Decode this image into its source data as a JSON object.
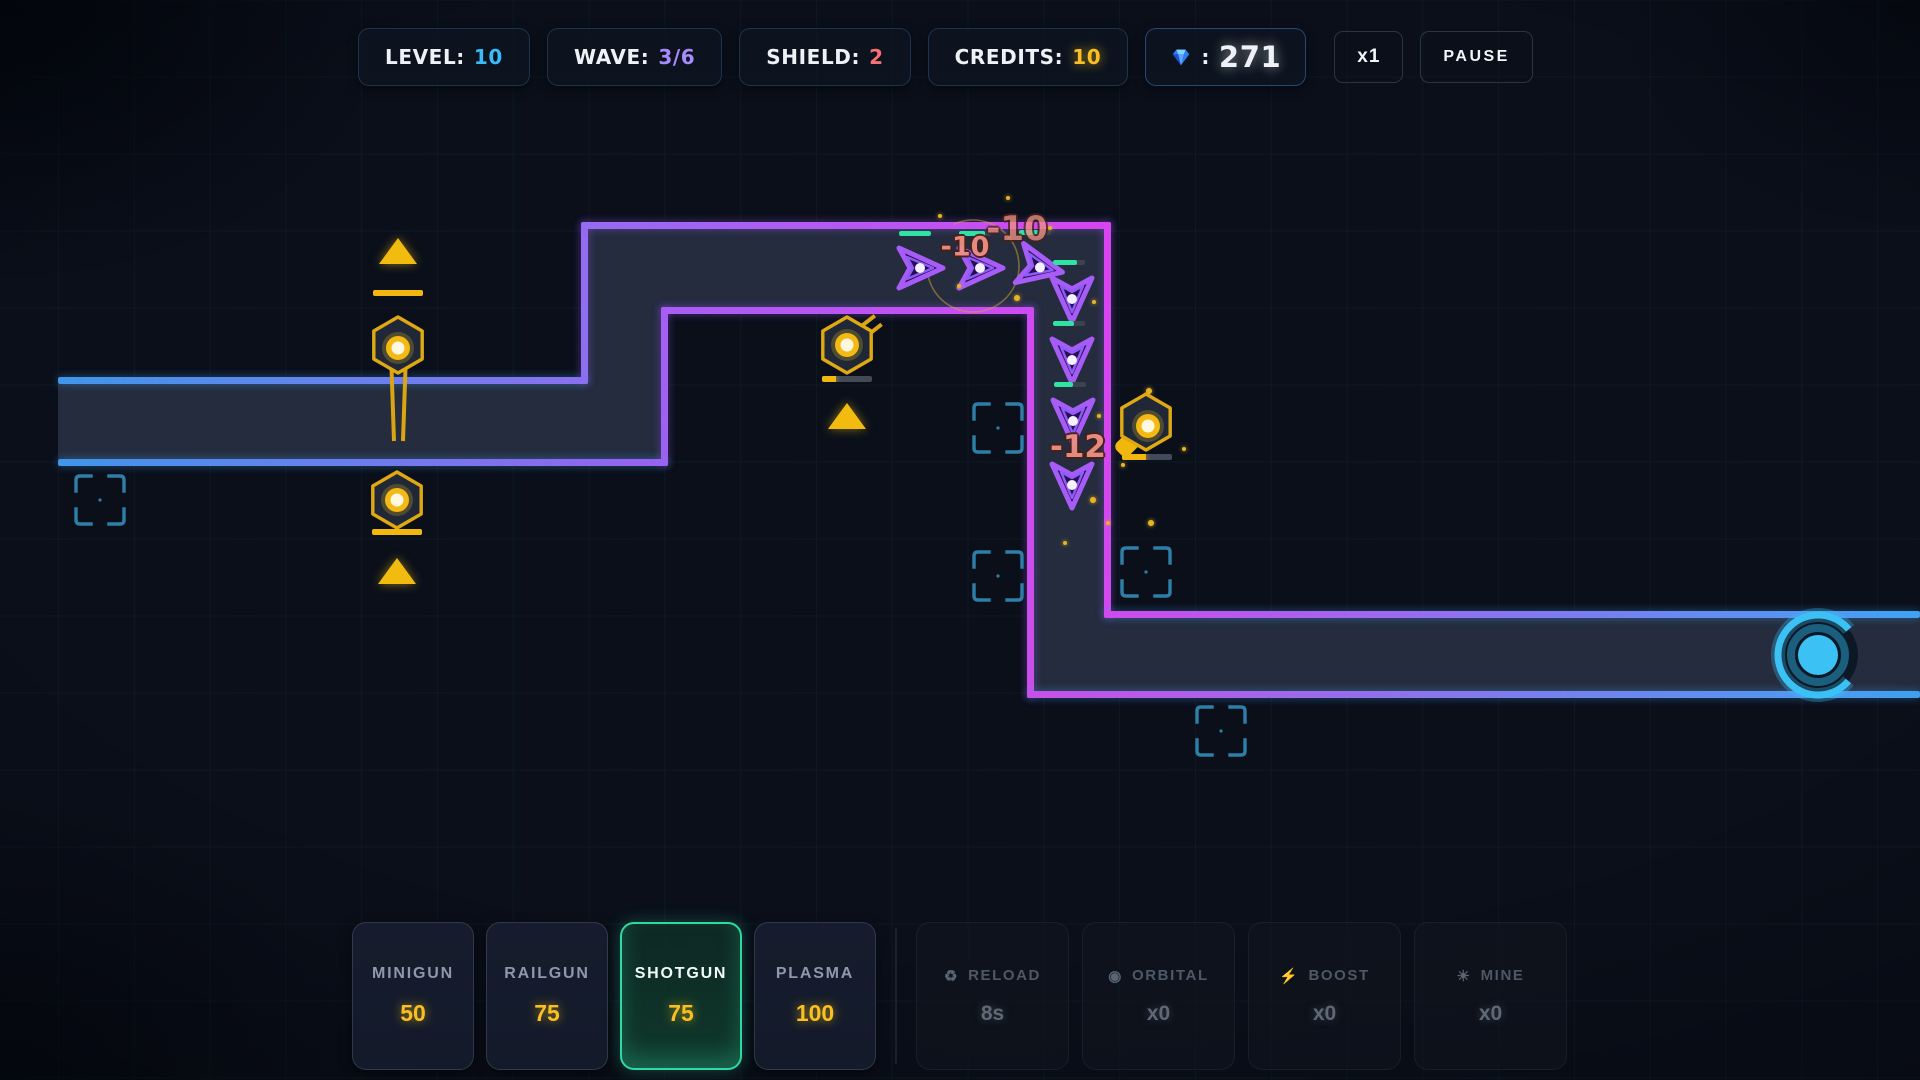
{
  "hud": {
    "level": {
      "label": "LEVEL:",
      "value": "10"
    },
    "wave": {
      "label": "WAVE:",
      "value": "3/6"
    },
    "shield": {
      "label": "SHIELD:",
      "value": "2"
    },
    "credits": {
      "label": "CREDITS:",
      "value": "10"
    },
    "gems": {
      "separator": ":",
      "value": "271"
    },
    "speed_button": "x1",
    "pause_button": "PAUSE"
  },
  "shop": {
    "towers": [
      {
        "name": "MINIGUN",
        "cost": "50",
        "selected": false
      },
      {
        "name": "RAILGUN",
        "cost": "75",
        "selected": false
      },
      {
        "name": "SHOTGUN",
        "cost": "75",
        "selected": true
      },
      {
        "name": "PLASMA",
        "cost": "100",
        "selected": false
      }
    ],
    "abilities": [
      {
        "glyph": "♻",
        "name": "RELOAD",
        "value": "8s"
      },
      {
        "glyph": "◉",
        "name": "ORBITAL",
        "value": "x0"
      },
      {
        "glyph": "⚡",
        "name": "BOOST",
        "value": "x0"
      },
      {
        "glyph": "☀",
        "name": "MINE",
        "value": "x0"
      }
    ]
  },
  "colors": {
    "accent_cyan": "#38bdf8",
    "accent_purple": "#a78bfa",
    "accent_red": "#f87171",
    "accent_gold": "#fbbf24",
    "enemy_purple": "#a85cf7",
    "health_green": "#2ee3a4",
    "path_blue": "#3f96ea",
    "path_magenta": "#d844f0",
    "tower_gold": "#e0a912",
    "selected_green": "#2fd9a2"
  },
  "battlefield": {
    "damage_numbers": [
      {
        "text": "-10",
        "x": 965,
        "y": 247,
        "size": 27,
        "opacity": 0.95
      },
      {
        "text": "-10",
        "x": 1017,
        "y": 229,
        "size": 34,
        "opacity": 0.78
      },
      {
        "text": "-12",
        "x": 1078,
        "y": 447,
        "size": 31,
        "opacity": 0.95
      }
    ],
    "enemies": [
      {
        "x": 918,
        "y": 268,
        "rot": -90,
        "hp": 1.0,
        "bar": true
      },
      {
        "x": 978,
        "y": 268,
        "rot": -90,
        "hp": 0.8,
        "bar": true
      },
      {
        "x": 1038,
        "y": 267,
        "rot": -78,
        "hp": 0.6,
        "bar": true
      },
      {
        "x": 1072,
        "y": 297,
        "rot": 0,
        "hp": 0.75,
        "bar": true
      },
      {
        "x": 1072,
        "y": 358,
        "rot": 0,
        "hp": 0.65,
        "bar": true
      },
      {
        "x": 1073,
        "y": 419,
        "rot": 0,
        "hp": 0.6,
        "bar": true
      },
      {
        "x": 1072,
        "y": 483,
        "rot": 0,
        "hp": 0.5,
        "bar": false
      }
    ],
    "towers": [
      {
        "x": 398,
        "y": 345,
        "barrel": "twin-down",
        "core_dx": 0,
        "core_dy": 3,
        "ammo": {
          "x": 398,
          "y": 290,
          "frac": 1.0
        },
        "triangle": {
          "x": 398,
          "y": 238
        }
      },
      {
        "x": 397,
        "y": 500,
        "barrel": "none",
        "core_dx": 0,
        "core_dy": 0,
        "ammo": {
          "x": 397,
          "y": 529,
          "frac": 1.0
        },
        "triangle": {
          "x": 397,
          "y": 558
        }
      },
      {
        "x": 847,
        "y": 345,
        "barrel": "twin-upright",
        "core_dx": 0,
        "core_dy": 0,
        "ammo": {
          "x": 847,
          "y": 376,
          "frac": 0.28
        },
        "triangle": {
          "x": 847,
          "y": 403
        }
      },
      {
        "x": 1146,
        "y": 422,
        "barrel": "fat-downleft",
        "core_dx": 2,
        "core_dy": 4,
        "ammo": {
          "x": 1147,
          "y": 454,
          "frac": 0.47
        },
        "triangle": null
      }
    ],
    "empty_slots": [
      {
        "x": 100,
        "y": 500
      },
      {
        "x": 998,
        "y": 428
      },
      {
        "x": 998,
        "y": 576
      },
      {
        "x": 1146,
        "y": 572
      },
      {
        "x": 1221,
        "y": 731
      }
    ],
    "target_ring": {
      "x": 973,
      "y": 266,
      "r": 46
    },
    "exit_portal": {
      "x": 1818,
      "y": 655
    },
    "particles": [
      {
        "x": 938,
        "y": 214,
        "r": 2
      },
      {
        "x": 1006,
        "y": 196,
        "r": 2
      },
      {
        "x": 1048,
        "y": 226,
        "r": 2
      },
      {
        "x": 957,
        "y": 284,
        "r": 2
      },
      {
        "x": 1014,
        "y": 295,
        "r": 3
      },
      {
        "x": 1092,
        "y": 300,
        "r": 2
      },
      {
        "x": 1146,
        "y": 388,
        "r": 3
      },
      {
        "x": 1097,
        "y": 414,
        "r": 2
      },
      {
        "x": 1121,
        "y": 463,
        "r": 2
      },
      {
        "x": 1090,
        "y": 497,
        "r": 3
      },
      {
        "x": 1106,
        "y": 521,
        "r": 2
      },
      {
        "x": 1148,
        "y": 520,
        "r": 3
      },
      {
        "x": 1063,
        "y": 541,
        "r": 2
      },
      {
        "x": 1182,
        "y": 447,
        "r": 2
      }
    ]
  }
}
